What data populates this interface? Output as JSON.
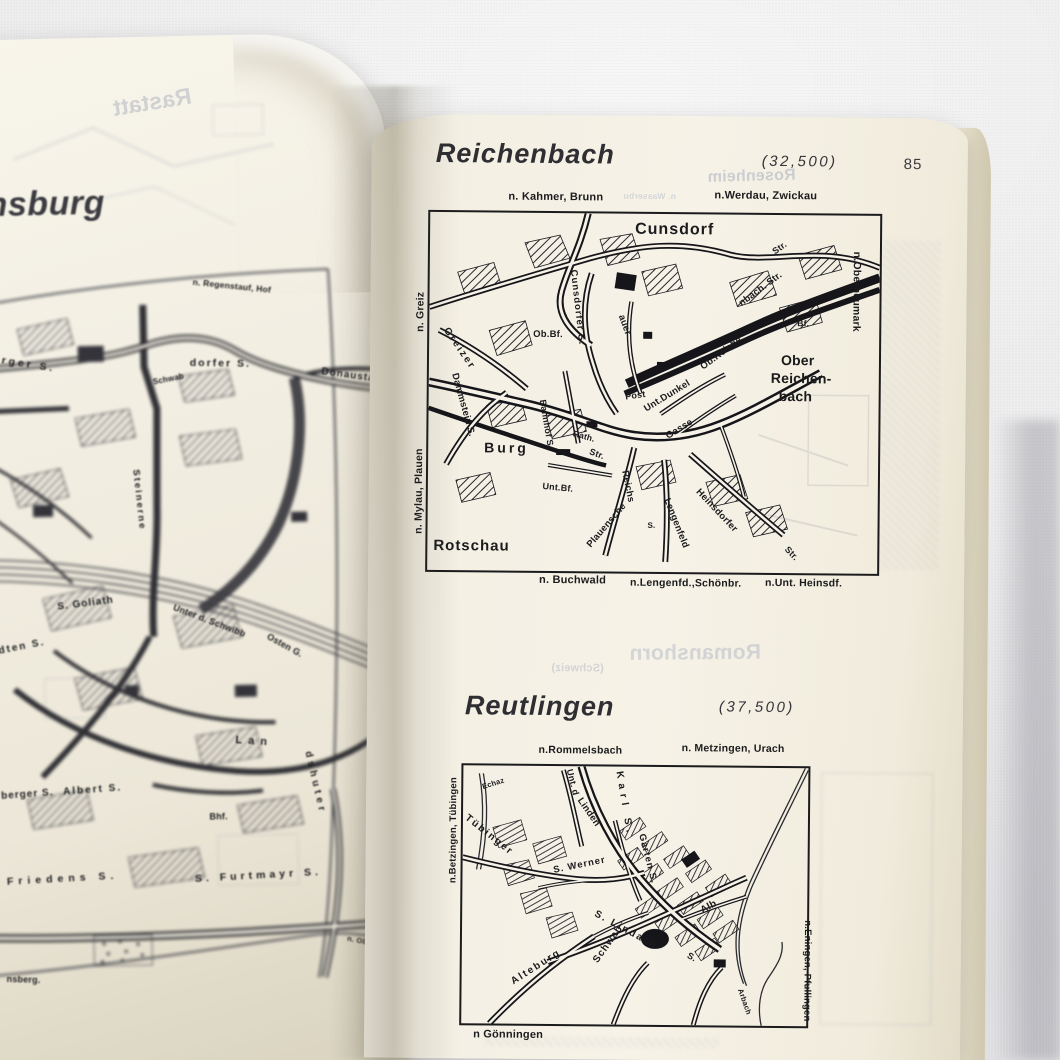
{
  "colors": {
    "ink": "#1b1b1d",
    "paper": "#f4f0e4",
    "paper_left": "#f1ede1",
    "fabric": "#ececed",
    "ghost": "#aab0c2"
  },
  "left_page": {
    "title_fragment": "nsburg",
    "labels": [
      {
        "t": "nsburg",
        "x": 12,
        "y": 148,
        "s": 34,
        "w": 600,
        "ls": 0.5,
        "c": "#3b3b40",
        "fs": "italic"
      },
      {
        "t": "n. Regenstauf, Hof",
        "x": 217,
        "y": 242,
        "r": 7,
        "s": 8.5
      },
      {
        "t": "erger S.",
        "x": 16,
        "y": 314,
        "r": 10,
        "s": 10.5,
        "ls": 3
      },
      {
        "t": "Schwab",
        "x": 174,
        "y": 342,
        "r": -10,
        "s": 8
      },
      {
        "t": "dorfer S.",
        "x": 212,
        "y": 322,
        "r": 2,
        "s": 10.5,
        "ls": 2
      },
      {
        "t": "Donaustauf",
        "x": 344,
        "y": 334,
        "r": 9,
        "s": 10,
        "ls": 1
      },
      {
        "t": "Steinerne",
        "x": 160,
        "y": 432,
        "r": 85,
        "s": 9.5,
        "ls": 2
      },
      {
        "t": "S. Goliath",
        "x": 74,
        "y": 564,
        "r": -6,
        "s": 10,
        "ls": 1
      },
      {
        "t": "Unter d. Schwibb",
        "x": 192,
        "y": 567,
        "r": 22,
        "s": 9
      },
      {
        "t": "Osten G.",
        "x": 286,
        "y": 598,
        "r": 30,
        "s": 9
      },
      {
        "t": "dten S.",
        "x": 14,
        "y": 607,
        "r": -10,
        "s": 10,
        "ls": 2
      },
      {
        "t": "Lan",
        "x": 250,
        "y": 700,
        "r": 5,
        "s": 11,
        "ls": 6
      },
      {
        "t": "dshuter",
        "x": 326,
        "y": 717,
        "r": 78,
        "s": 10,
        "ls": 4
      },
      {
        "t": "berger S.",
        "x": 14,
        "y": 752,
        "r": -3,
        "s": 10,
        "ls": 1
      },
      {
        "t": "Albert S.",
        "x": 76,
        "y": 749,
        "r": -3,
        "s": 10,
        "ls": 2
      },
      {
        "t": "Bhf.",
        "x": 222,
        "y": 777,
        "s": 9
      },
      {
        "t": "Friedens S.",
        "x": 18,
        "y": 837,
        "r": -2,
        "s": 10.5,
        "ls": 5
      },
      {
        "t": "S. Furtmayr S.",
        "x": 206,
        "y": 838,
        "r": -2,
        "s": 10.5,
        "ls": 4
      },
      {
        "t": "nsberg.",
        "x": 16,
        "y": 935,
        "r": 3,
        "s": 9
      },
      {
        "t": "n. Ob.Traubl.",
        "x": 358,
        "y": 902,
        "r": 12,
        "s": 7.5
      }
    ],
    "showthrough": [
      {
        "t": "Rastatt",
        "x": 140,
        "y": 54,
        "r": 8,
        "s": 23,
        "m": 1,
        "o": 0.38,
        "c": "#949bad"
      }
    ]
  },
  "right_page": {
    "page_number": "85",
    "map1": {
      "title": "Reichenbach",
      "scale": "(32,500)",
      "labels": [
        {
          "t": "n. Kahmer, Brunn",
          "x": 78,
          "y": -21,
          "s": 11
        },
        {
          "t": "n.Werdau, Zwickau",
          "x": 284,
          "y": -24,
          "s": 11
        },
        {
          "t": "n.Oberneumark",
          "x": 432,
          "y": 36,
          "r": 90,
          "s": 10.5
        },
        {
          "t": "n. Greiz",
          "x": -14,
          "y": 120,
          "r": -90,
          "s": 10.5
        },
        {
          "t": "n. Mylau, Plauen",
          "x": -14,
          "y": 322,
          "r": -90,
          "s": 10.5
        },
        {
          "t": "Cunsdorf",
          "x": 205,
          "y": 8,
          "s": 16,
          "ls": 1
        },
        {
          "t": "Str.",
          "x": 341,
          "y": 34,
          "r": -36,
          "s": 9
        },
        {
          "t": "Ob.Bf.",
          "x": 104,
          "y": 117,
          "s": 9.5
        },
        {
          "t": "Greizer",
          "x": 20,
          "y": 114,
          "r": 55,
          "s": 10,
          "ls": 2
        },
        {
          "t": "Cunsdorfer S.",
          "x": 148,
          "y": 56,
          "r": 83,
          "s": 9.5,
          "ls": 1
        },
        {
          "t": "auer",
          "x": 196,
          "y": 100,
          "r": 70,
          "s": 9.5
        },
        {
          "t": "nbach. Str.",
          "x": 308,
          "y": 86,
          "r": -37,
          "s": 9.5
        },
        {
          "t": "Ob.Reiche",
          "x": 270,
          "y": 150,
          "r": -37,
          "s": 9.5
        },
        {
          "t": "Bf.",
          "x": 368,
          "y": 104,
          "s": 8.5
        },
        {
          "t": "Ober",
          "x": 352,
          "y": 138,
          "s": 14
        },
        {
          "t": "Reichen-",
          "x": 342,
          "y": 156,
          "s": 14
        },
        {
          "t": "bach",
          "x": 350,
          "y": 174,
          "s": 14
        },
        {
          "t": "Dammstein S.",
          "x": 30,
          "y": 160,
          "r": 74,
          "s": 9.5
        },
        {
          "t": "Bahnhof S.",
          "x": 118,
          "y": 186,
          "r": 80,
          "s": 9
        },
        {
          "t": "Rath.",
          "x": 146,
          "y": 216,
          "r": 15,
          "s": 8.5
        },
        {
          "t": "Post",
          "x": 196,
          "y": 179,
          "r": -8,
          "s": 9
        },
        {
          "t": "Unt.Dunkel",
          "x": 214,
          "y": 192,
          "r": -32,
          "s": 9.5
        },
        {
          "t": "Gasse",
          "x": 236,
          "y": 219,
          "r": -32,
          "s": 9.5
        },
        {
          "t": "Burg",
          "x": 56,
          "y": 228,
          "s": 14,
          "ls": 3
        },
        {
          "t": "Str.",
          "x": 163,
          "y": 234,
          "r": 20,
          "s": 9
        },
        {
          "t": "Unt.Bf.",
          "x": 115,
          "y": 269,
          "r": 5,
          "s": 9
        },
        {
          "t": "Reichs",
          "x": 201,
          "y": 256,
          "r": 78,
          "s": 9.5
        },
        {
          "t": "Plauensche",
          "x": 158,
          "y": 330,
          "r": -50,
          "s": 9.5
        },
        {
          "t": "Lengenfeld",
          "x": 243,
          "y": 283,
          "r": 68,
          "s": 9.5
        },
        {
          "t": "S.",
          "x": 220,
          "y": 308,
          "s": 8
        },
        {
          "t": "Heinsdorfer",
          "x": 273,
          "y": 273,
          "r": 46,
          "s": 9.5
        },
        {
          "t": "Str.",
          "x": 362,
          "y": 330,
          "r": 46,
          "s": 9
        },
        {
          "t": "Rotschau",
          "x": 6,
          "y": 326,
          "s": 15,
          "ls": 1
        },
        {
          "t": "n. Buchwald",
          "x": 112,
          "y": 362,
          "s": 11
        },
        {
          "t": "n.Lengenfd.,Schönbr.",
          "x": 203,
          "y": 364,
          "s": 10.5
        },
        {
          "t": "n.Unt. Heinsdf.",
          "x": 338,
          "y": 363,
          "s": 10.5
        }
      ]
    },
    "map2": {
      "title": "Reutlingen",
      "scale": "(37,500)",
      "labels": [
        {
          "t": "n.Rommelsbach",
          "x": 75,
          "y": -21,
          "s": 10.5
        },
        {
          "t": "n. Metzingen, Urach",
          "x": 218,
          "y": -24,
          "s": 10.5
        },
        {
          "t": "n.Betzingen, Tübingen",
          "x": -14,
          "y": 118,
          "r": -90,
          "s": 9.5
        },
        {
          "t": "n.Eningen, Pfullingen",
          "x": 350,
          "y": 152,
          "r": 90,
          "s": 9.5
        },
        {
          "t": "n Gönningen",
          "x": 12,
          "y": 264,
          "s": 11
        },
        {
          "t": "Echaz",
          "x": 18,
          "y": 18,
          "r": -18,
          "s": 7.5
        },
        {
          "t": "Tübinger",
          "x": 6,
          "y": 48,
          "r": 38,
          "s": 10,
          "ls": 2
        },
        {
          "t": "Unt. d",
          "x": 110,
          "y": 2,
          "r": 75,
          "s": 9
        },
        {
          "t": "Linden",
          "x": 120,
          "y": 30,
          "r": 55,
          "s": 9.5
        },
        {
          "t": "Karl S.",
          "x": 160,
          "y": 4,
          "r": 80,
          "s": 10,
          "ls": 5
        },
        {
          "t": "Garten S.",
          "x": 183,
          "y": 66,
          "r": 75,
          "s": 9.5,
          "ls": 1
        },
        {
          "t": "S. Werner",
          "x": 90,
          "y": 100,
          "r": -12,
          "s": 9.5,
          "ls": 1
        },
        {
          "t": "Alb",
          "x": 237,
          "y": 140,
          "r": -30,
          "s": 10
        },
        {
          "t": "S. Lindach",
          "x": 135,
          "y": 143,
          "r": 28,
          "s": 10,
          "ls": 2
        },
        {
          "t": "S.",
          "x": 228,
          "y": 184,
          "r": 28,
          "s": 9
        },
        {
          "t": "Schwab",
          "x": 130,
          "y": 193,
          "r": -55,
          "s": 10,
          "ls": 1
        },
        {
          "t": "Alteburg",
          "x": 48,
          "y": 213,
          "r": -33,
          "s": 10,
          "ls": 2
        },
        {
          "t": "Arbach",
          "x": 282,
          "y": 220,
          "r": 70,
          "s": 7.5
        }
      ]
    },
    "showthrough": [
      {
        "t": "Rosenheim",
        "x": 336,
        "y": 52,
        "r": 2,
        "s": 16,
        "m": 1,
        "o": 0.55,
        "c": "#aab0c2"
      },
      {
        "t": "n. Wasserbu",
        "x": 252,
        "y": 76,
        "s": 8.5,
        "m": 1,
        "o": 0.5,
        "c": "#b3bac9"
      },
      {
        "t": "(Schweiz)",
        "x": 184,
        "y": 548,
        "s": 11,
        "m": 1,
        "o": 0.45,
        "c": "#aab0c2"
      },
      {
        "t": "Romanshorn",
        "x": 262,
        "y": 526,
        "r": 1,
        "s": 21,
        "m": 1,
        "o": 0.45,
        "c": "#aab0c2"
      }
    ]
  }
}
